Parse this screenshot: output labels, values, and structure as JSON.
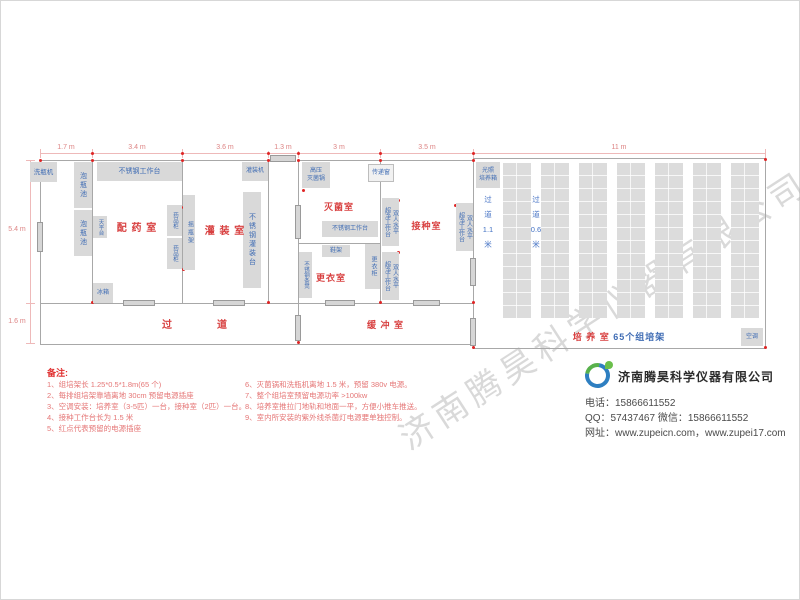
{
  "watermark": "济南腾昊科学仪器有限公司",
  "colors": {
    "room_label": "#d84040",
    "equipment_text": "#3f6cb4",
    "dimension_text": "#dd8484",
    "notes_text": "#e57676",
    "outlet_dot": "#e02525",
    "brand_blue": "#2e7fc1",
    "brand_green": "#58b14c"
  },
  "plan": {
    "dims_top": [
      "1.7 m",
      "3.4 m",
      "3.6 m",
      "1.3 m",
      "3 m",
      "3.5 m",
      "11 m"
    ],
    "dims_left": [
      "5.4 m",
      "1.6 m"
    ],
    "rooms": {
      "peiyao": "配 药 室",
      "guanzhuang": "灌 装 室",
      "miejun": "灭菌室",
      "gengyi": "更衣室",
      "jiezhong": "接种室",
      "guodao": "过　　　　道",
      "huanchong": "缓 冲 室",
      "peiyang": "培 养 室 ",
      "peiyang_sub": "65个组培架"
    },
    "corridor_labels": {
      "c1": [
        "过",
        "道",
        "1.1",
        "米"
      ],
      "c2": [
        "过",
        "道",
        "0.6",
        "米"
      ]
    },
    "equipment": {
      "washer": "洗瓶机",
      "soak": "泡瓶池",
      "bench": "不锈钢工作台",
      "balance": "天平台",
      "fridge": "冰箱",
      "cabinet": "药品柜",
      "shaker": "摇瓶架",
      "fill_bench": "不锈钢灌装台",
      "filler": "灌装机",
      "autoclave": [
        "高压",
        "灭菌锅"
      ],
      "shoe": "鞋架",
      "locker": "更衣柜",
      "stool": "不锈钢条凳",
      "pass": "传递窗",
      "laminar": [
        "双人水平",
        "超净工作台"
      ],
      "incubator": [
        "光照",
        "培养箱"
      ],
      "ac": "空调"
    }
  },
  "notes": {
    "header": "备注:",
    "left": [
      "1、组培架长 1.25*0.5*1.8m(65 个)",
      "2、每排组培架靠墙离地 30cm 预留电源插座",
      "3、空调安装：培养室（3-5匹）一台，接种室（2匹）一台。",
      "4、接种工作台长为 1.5 米",
      "5、红点代表预留的电源插座"
    ],
    "right": [
      "6、灭菌锅和洗瓶机离地 1.5 米，预留 380v 电源。",
      "7、整个组培室预留电源功率 >100kw",
      "8、培养室推拉门地轨和地面一平，方便小推车推送。",
      "9、室内所安装的紫外线杀菌灯电源要单独控制。"
    ]
  },
  "company": {
    "name": "济南腾昊科学仪器有限公司",
    "phone": "电话：15866611552",
    "qq": "QQ：57437467  微信：15866611552",
    "web": "网址：www.zupeicn.com，www.zupei17.com"
  }
}
